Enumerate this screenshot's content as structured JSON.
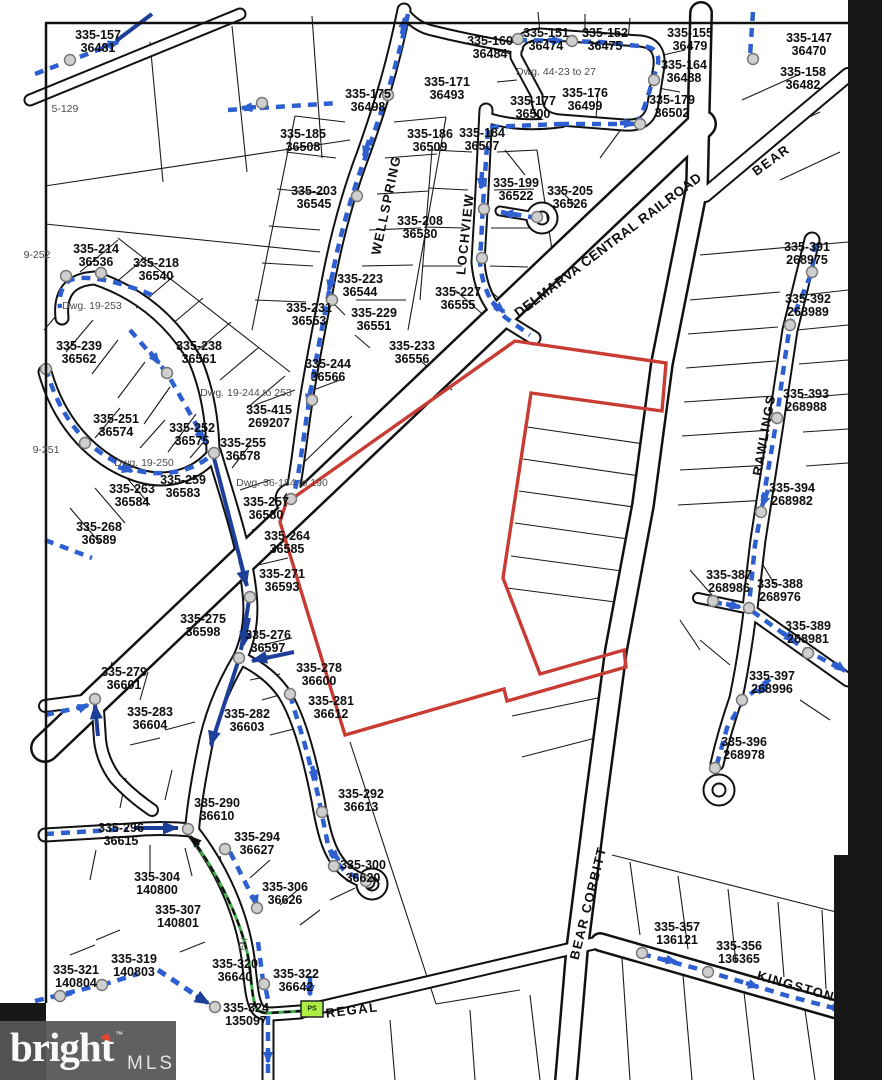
{
  "parcels": [
    {
      "lot": "335-157",
      "tax": "36481"
    },
    {
      "lot": "335-160",
      "tax": "36484"
    },
    {
      "lot": "335-151",
      "tax": "36474"
    },
    {
      "lot": "335-152",
      "tax": "36475"
    },
    {
      "lot": "335-155",
      "tax": "36479"
    },
    {
      "lot": "335-147",
      "tax": "36470"
    },
    {
      "lot": "335-164",
      "tax": "36488"
    },
    {
      "lot": "335-158",
      "tax": "36482"
    },
    {
      "lot": "335-171",
      "tax": "36493"
    },
    {
      "lot": "335-175",
      "tax": "36498"
    },
    {
      "lot": "335-179",
      "tax": "36502"
    },
    {
      "lot": "335-176",
      "tax": "36499"
    },
    {
      "lot": "335-177",
      "tax": "36500"
    },
    {
      "lot": "335-185",
      "tax": "36508"
    },
    {
      "lot": "335-186",
      "tax": "36509"
    },
    {
      "lot": "335-184",
      "tax": "36507"
    },
    {
      "lot": "335-199",
      "tax": "36522"
    },
    {
      "lot": "335-205",
      "tax": "36526"
    },
    {
      "lot": "335-203",
      "tax": "36545"
    },
    {
      "lot": "335-208",
      "tax": "36530"
    },
    {
      "lot": "335-214",
      "tax": "36536"
    },
    {
      "lot": "335-218",
      "tax": "36540"
    },
    {
      "lot": "335-239",
      "tax": "36562"
    },
    {
      "lot": "335-238",
      "tax": "36561"
    },
    {
      "lot": "335-223",
      "tax": "36544"
    },
    {
      "lot": "335-227",
      "tax": "36555"
    },
    {
      "lot": "335-231",
      "tax": "36553"
    },
    {
      "lot": "335-229",
      "tax": "36551"
    },
    {
      "lot": "335-233",
      "tax": "36556"
    },
    {
      "lot": "335-244",
      "tax": "36566"
    },
    {
      "lot": "335-415",
      "tax": "269207"
    },
    {
      "lot": "335-251",
      "tax": "36574"
    },
    {
      "lot": "335-252",
      "tax": "36575"
    },
    {
      "lot": "335-255",
      "tax": "36578"
    },
    {
      "lot": "335-259",
      "tax": "36583"
    },
    {
      "lot": "335-263",
      "tax": "36584"
    },
    {
      "lot": "335-268",
      "tax": "36589"
    },
    {
      "lot": "335-257",
      "tax": "36580"
    },
    {
      "lot": "335-264",
      "tax": "36585"
    },
    {
      "lot": "335-271",
      "tax": "36593"
    },
    {
      "lot": "335-275",
      "tax": "36598"
    },
    {
      "lot": "335-276",
      "tax": "36597"
    },
    {
      "lot": "335-279",
      "tax": "36601"
    },
    {
      "lot": "335-283",
      "tax": "36604"
    },
    {
      "lot": "335-282",
      "tax": "36603"
    },
    {
      "lot": "335-278",
      "tax": "36600"
    },
    {
      "lot": "335-281",
      "tax": "36612"
    },
    {
      "lot": "335-292",
      "tax": "36613"
    },
    {
      "lot": "335-290",
      "tax": "36610"
    },
    {
      "lot": "335-296",
      "tax": "36615"
    },
    {
      "lot": "335-294",
      "tax": "36627"
    },
    {
      "lot": "335-300",
      "tax": "36620"
    },
    {
      "lot": "335-304",
      "tax": "140800"
    },
    {
      "lot": "335-306",
      "tax": "36626"
    },
    {
      "lot": "335-307",
      "tax": "140801"
    },
    {
      "lot": "335-319",
      "tax": "140803"
    },
    {
      "lot": "335-321",
      "tax": "140804"
    },
    {
      "lot": "335-320",
      "tax": "36640"
    },
    {
      "lot": "335-322",
      "tax": "36642"
    },
    {
      "lot": "335-324",
      "tax": "135097"
    },
    {
      "lot": "335-391",
      "tax": "268975"
    },
    {
      "lot": "335-392",
      "tax": "268989"
    },
    {
      "lot": "335-393",
      "tax": "268988"
    },
    {
      "lot": "335-394",
      "tax": "268982"
    },
    {
      "lot": "335-387",
      "tax": "268986"
    },
    {
      "lot": "335-388",
      "tax": "268976"
    },
    {
      "lot": "335-389",
      "tax": "268981"
    },
    {
      "lot": "335-397",
      "tax": "268996"
    },
    {
      "lot": "335-396",
      "tax": "268978"
    },
    {
      "lot": "335-357",
      "tax": "136121"
    },
    {
      "lot": "335-356",
      "tax": "136365"
    }
  ],
  "streets": [
    {
      "name": "WELLSPRING"
    },
    {
      "name": "LOCHVIEW"
    },
    {
      "name": "DELMARVA CENTRAL RAILROAD"
    },
    {
      "name": "BEAR"
    },
    {
      "name": "RAWLINGS"
    },
    {
      "name": "BEAR CORBITT"
    },
    {
      "name": "KINGSTON"
    },
    {
      "name": "REGAL"
    }
  ],
  "notes": [
    ". 5-129",
    "Dwg. 44-23 to 27",
    "9-252",
    "Dwg. 19-253",
    "Dwg. 19-244 to 253",
    "Dwg. 19-250",
    "9-251",
    "Dwg. 36-184 to 190",
    "FM",
    "PS"
  ],
  "logo": {
    "brand": "bright",
    "tm": "™",
    "suffix": "MLS"
  },
  "colors": {
    "boundary": "#c83c34",
    "sewer_line": "#2e5fd0",
    "flow_arrow": "#1d3f9a",
    "force_main": "#3fae4a",
    "pump_station_fill": "#abef46",
    "manhole_fill": "#cfcfcf"
  }
}
